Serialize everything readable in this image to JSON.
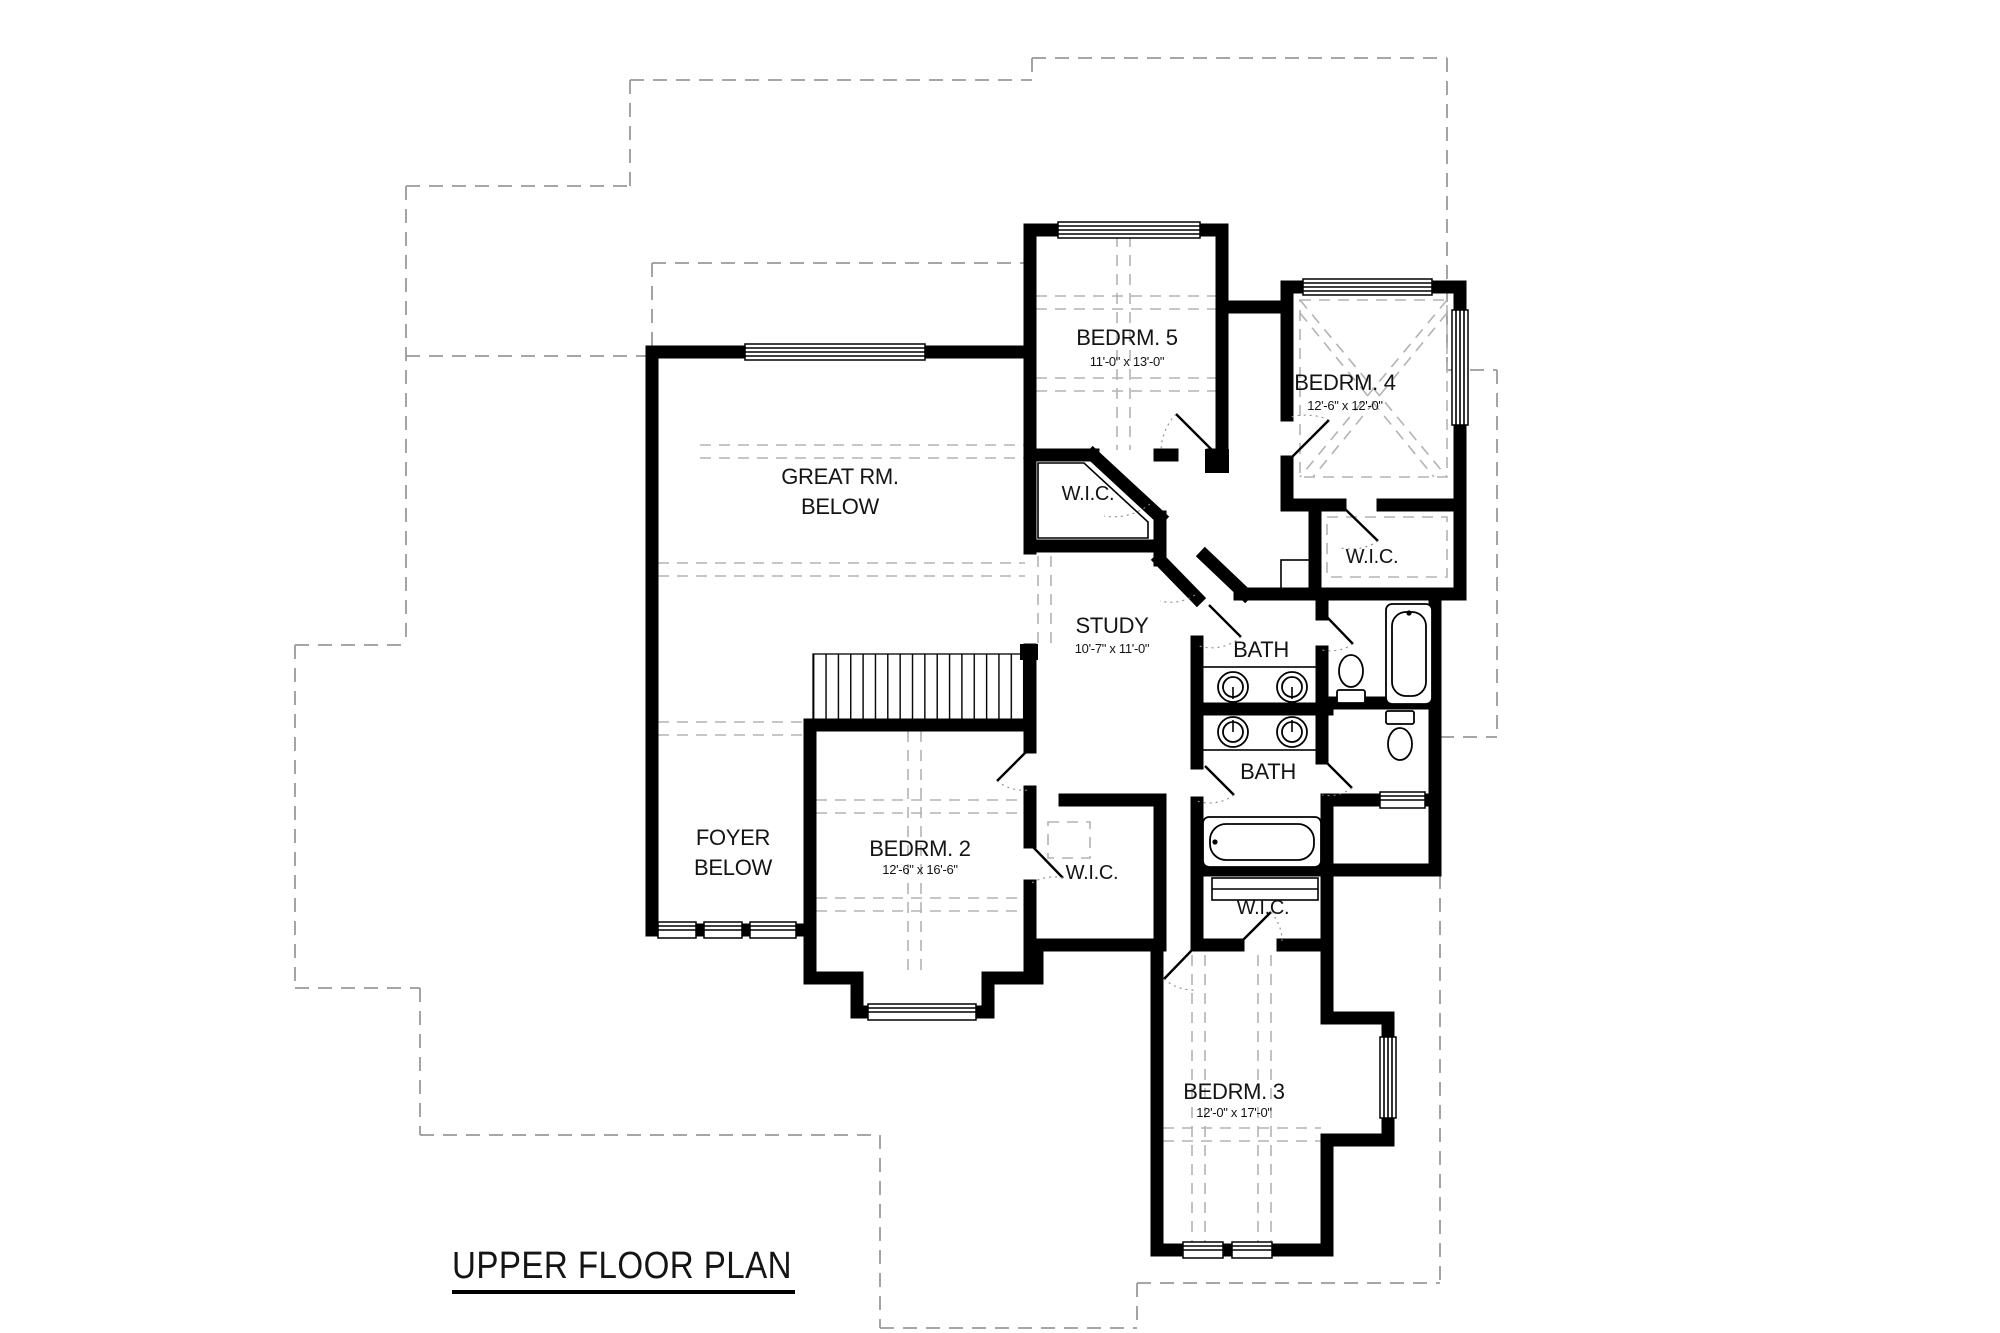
{
  "title": "UPPER FLOOR PLAN",
  "rooms": {
    "great_room": {
      "l1": "GREAT RM.",
      "l2": "BELOW"
    },
    "foyer": {
      "l1": "FOYER",
      "l2": "BELOW"
    },
    "bedroom5": {
      "name": "BEDRM. 5",
      "dims": "11'-0\" x 13'-0\""
    },
    "bedroom4": {
      "name": "BEDRM. 4",
      "dims": "12'-6\" x 12'-0\""
    },
    "study": {
      "name": "STUDY",
      "dims": "10'-7\" x 11'-0\""
    },
    "bedroom2": {
      "name": "BEDRM. 2",
      "dims": "12'-6\" x 16'-6\""
    },
    "bedroom3": {
      "name": "BEDRM. 3",
      "dims": "12'-0\" x 17'-0\""
    },
    "bath_upper": {
      "name": "BATH"
    },
    "bath_lower": {
      "name": "BATH"
    },
    "wic_bedroom5": {
      "name": "W.I.C."
    },
    "wic_bedroom4": {
      "name": "W.I.C."
    },
    "wic_bedroom2": {
      "name": "W.I.C."
    },
    "wic_bedroom3": {
      "name": "W.I.C."
    }
  },
  "colors": {
    "wall": "#000000",
    "roof_dash": "#9a9a9a",
    "ceiling_dash": "#b3b3b3",
    "background": "#ffffff"
  }
}
